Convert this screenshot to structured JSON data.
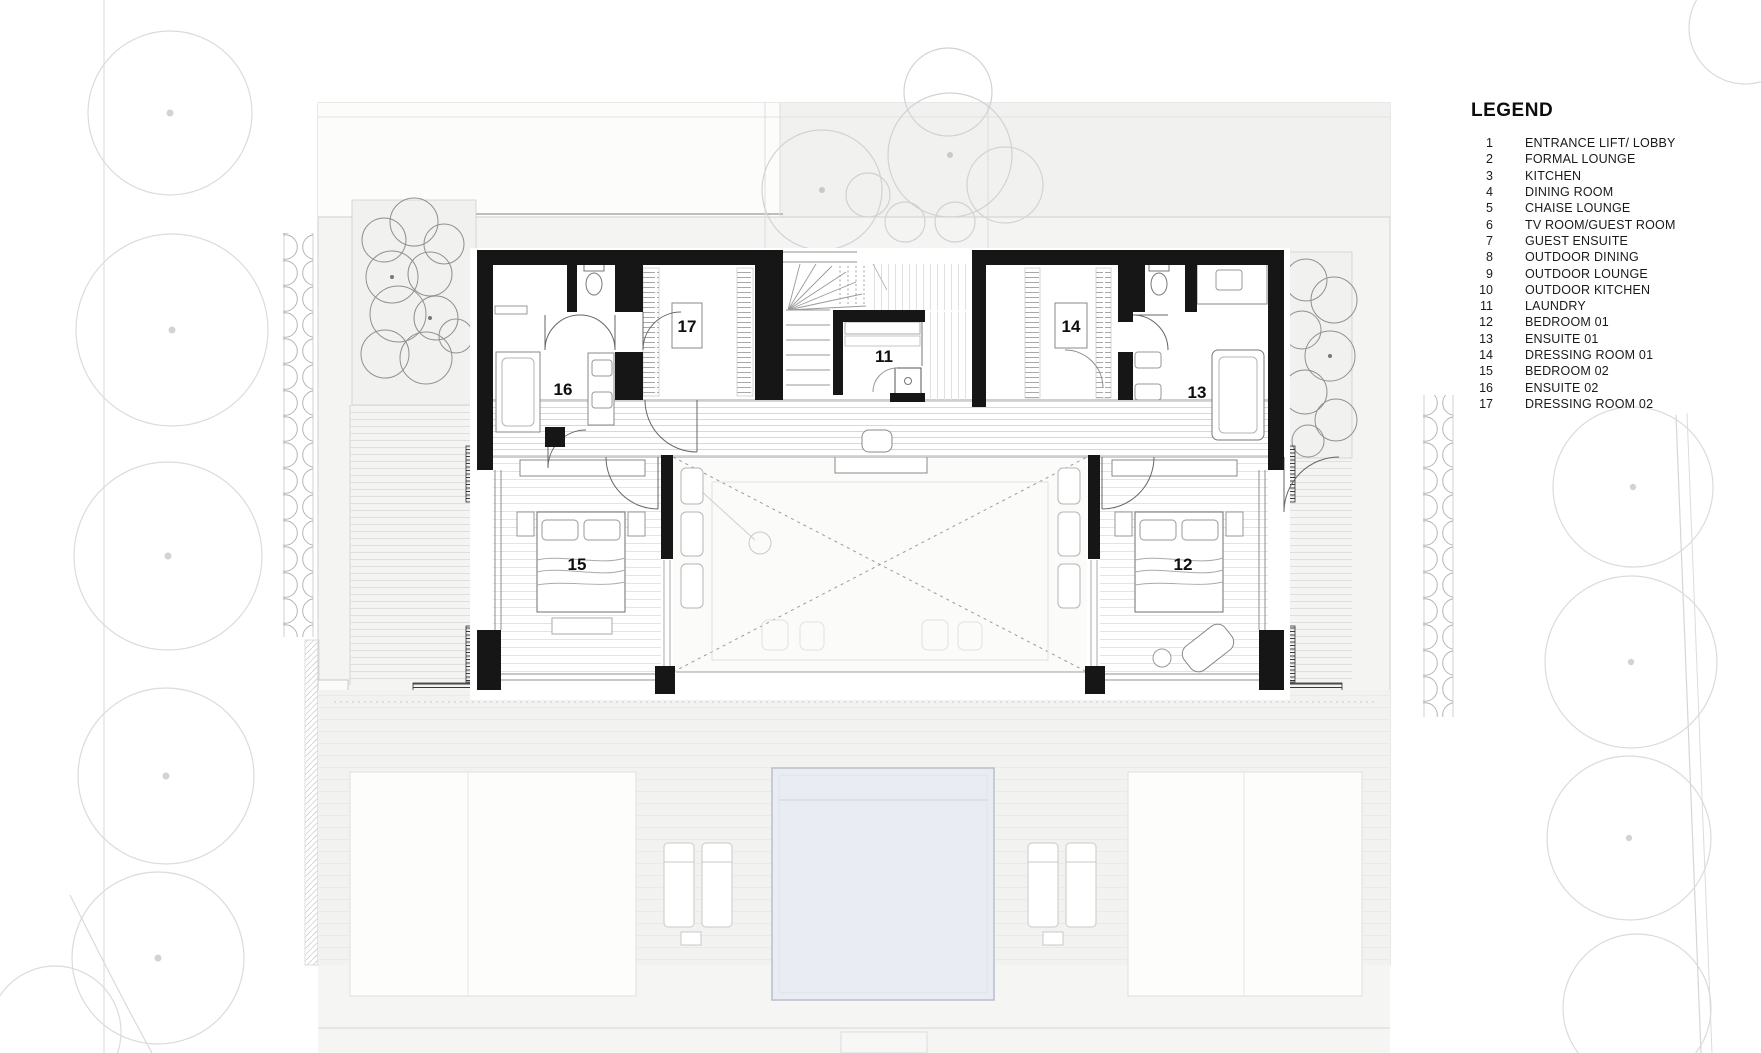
{
  "legend": {
    "title": "LEGEND",
    "items": [
      {
        "num": "1",
        "label": "ENTRANCE LIFT/ LOBBY"
      },
      {
        "num": "2",
        "label": "FORMAL LOUNGE"
      },
      {
        "num": "3",
        "label": "KITCHEN"
      },
      {
        "num": "4",
        "label": "DINING ROOM"
      },
      {
        "num": "5",
        "label": "CHAISE LOUNGE"
      },
      {
        "num": "6",
        "label": "TV ROOM/GUEST ROOM"
      },
      {
        "num": "7",
        "label": "GUEST ENSUITE"
      },
      {
        "num": "8",
        "label": "OUTDOOR DINING"
      },
      {
        "num": "9",
        "label": "OUTDOOR LOUNGE"
      },
      {
        "num": "10",
        "label": "OUTDOOR KITCHEN"
      },
      {
        "num": "11",
        "label": "LAUNDRY"
      },
      {
        "num": "12",
        "label": "BEDROOM 01"
      },
      {
        "num": "13",
        "label": "ENSUITE 01"
      },
      {
        "num": "14",
        "label": "DRESSING ROOM 01"
      },
      {
        "num": "15",
        "label": "BEDROOM 02"
      },
      {
        "num": "16",
        "label": "ENSUITE 02"
      },
      {
        "num": "17",
        "label": "DRESSING ROOM 02"
      }
    ]
  },
  "plan": {
    "room_labels": [
      {
        "number": "16"
      },
      {
        "number": "17"
      },
      {
        "number": "11"
      },
      {
        "number": "14"
      },
      {
        "number": "13"
      },
      {
        "number": "15"
      },
      {
        "number": "12"
      }
    ]
  },
  "colors": {
    "wall": "#161616",
    "pool_fill": "#e9edf3",
    "pool_edge": "#b9bfc9",
    "site_fill": "#f4f4f3",
    "text": "#111111"
  }
}
